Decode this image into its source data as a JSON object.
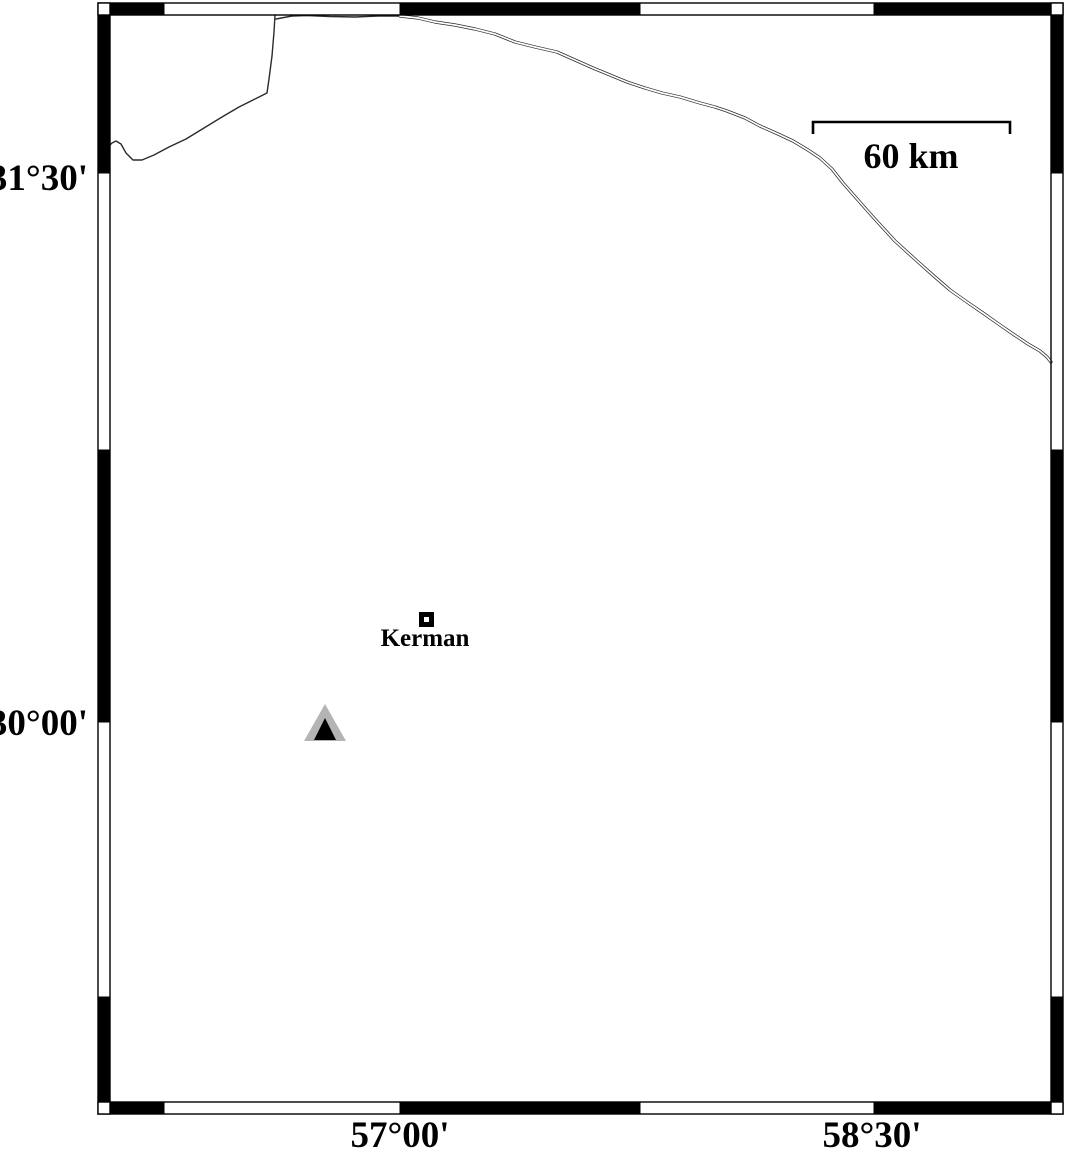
{
  "frame_annotations": {
    "lat_upper": "31°30'",
    "lat_lower": "30°00'",
    "lon_left": "57°00'",
    "lon_right": "58°30'"
  },
  "scale_bar": {
    "label": "60 km"
  },
  "city": {
    "label": "Kerman"
  },
  "icons": {
    "city_marker": "square-icon",
    "station_marker": "triangle-icon"
  },
  "colors": {
    "ink": "#000000",
    "background": "#ffffff",
    "line_gray": "#2b2b2b",
    "station_gray": "#b4b4b4",
    "station_inner": "#000000"
  }
}
